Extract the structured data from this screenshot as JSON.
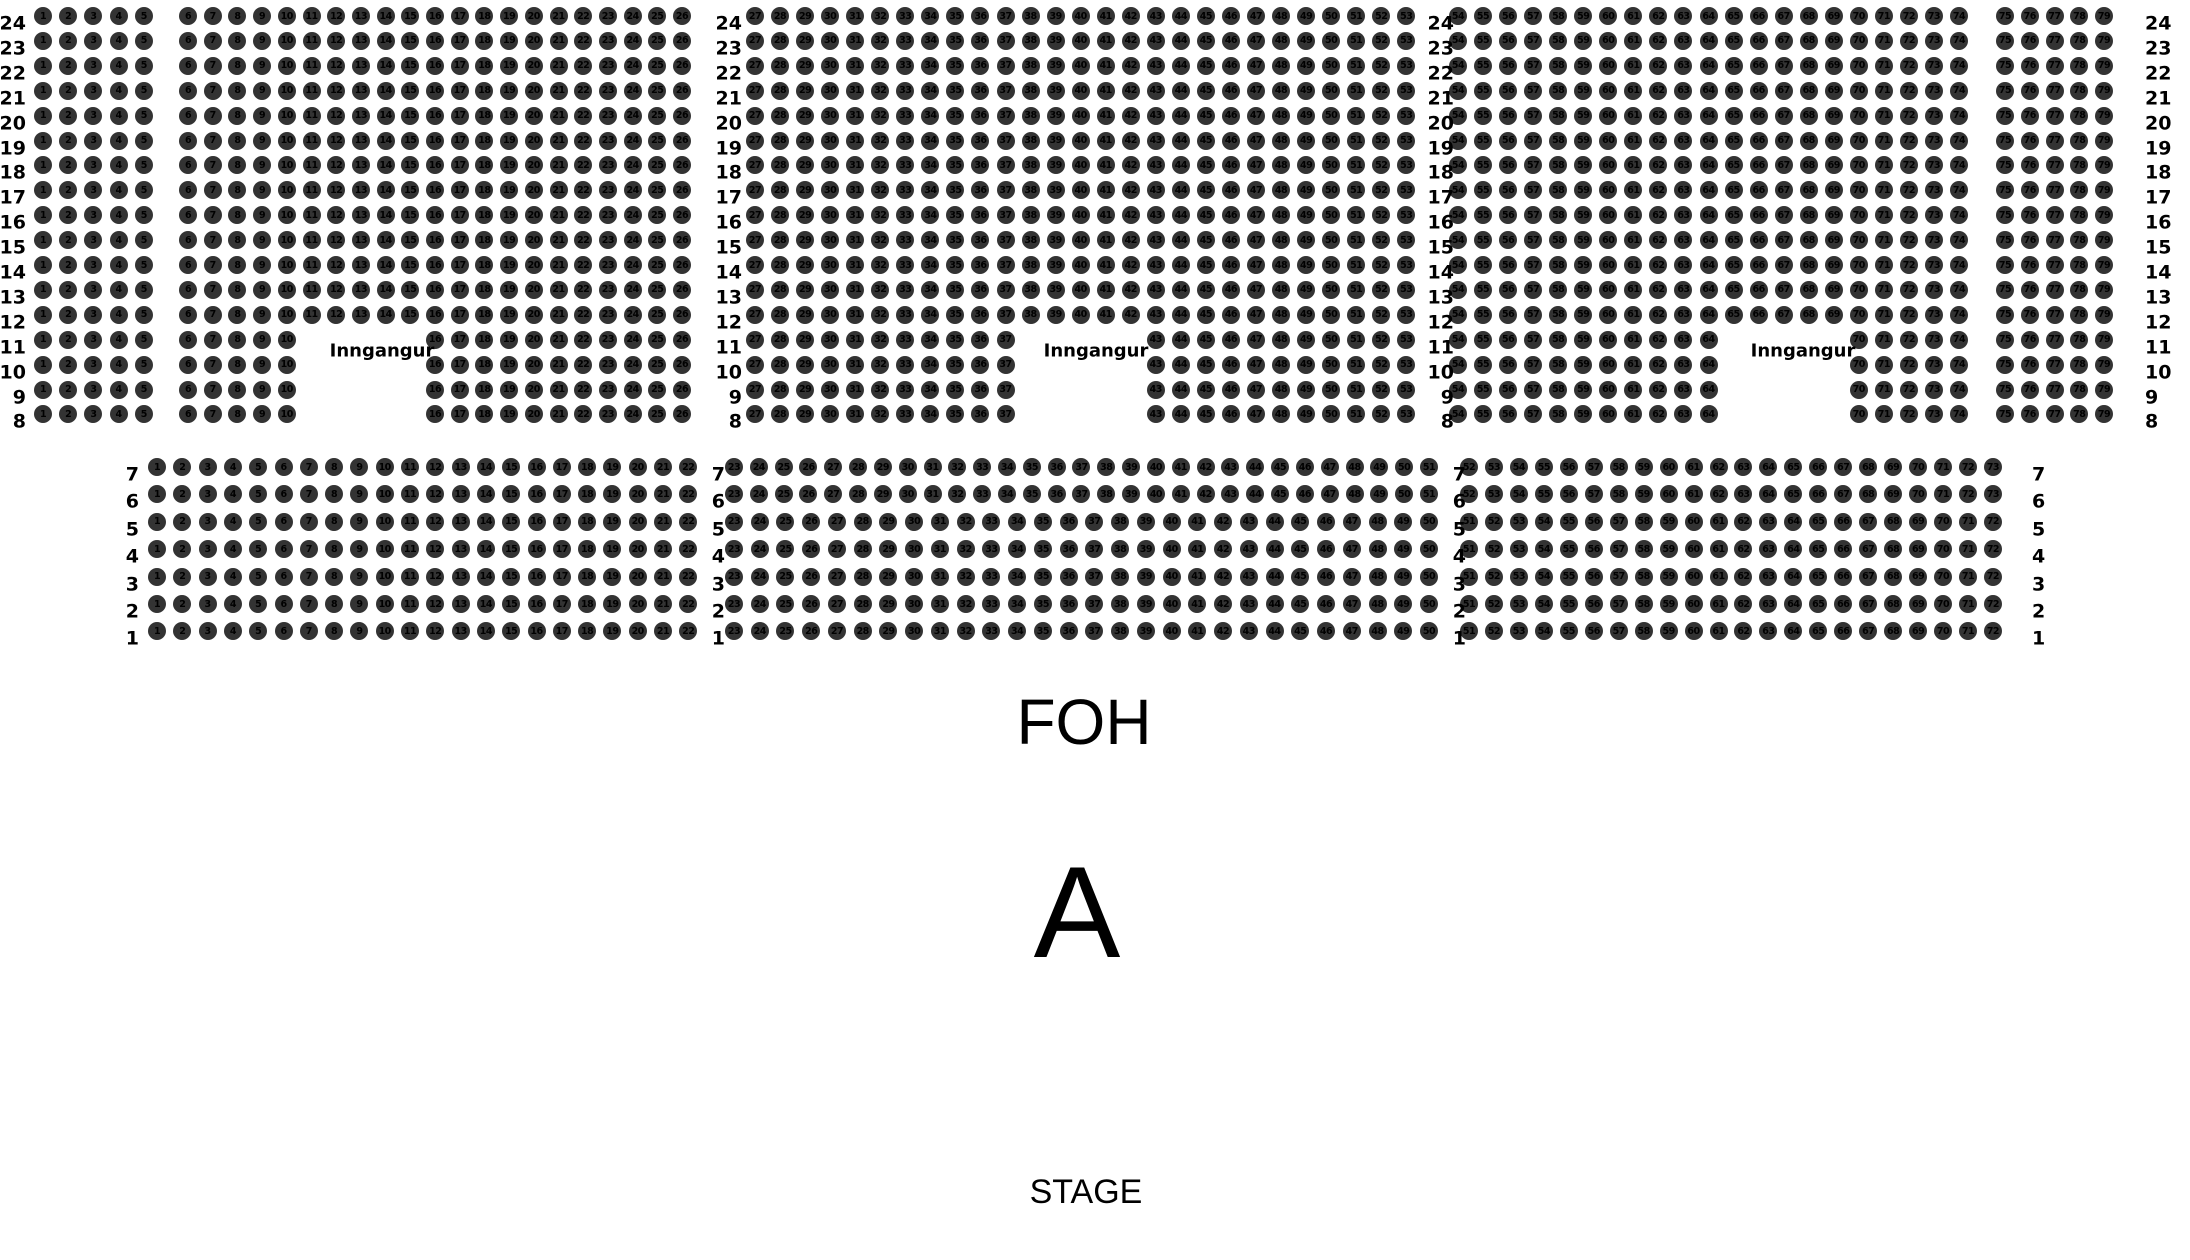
{
  "page": {
    "width": 2190,
    "height": 1260,
    "background": "#ffffff"
  },
  "colors": {
    "seat_fill": "#333333",
    "seat_number_text": "#000000",
    "label_text": "#000000"
  },
  "labels": {
    "entrance": "Inngangur",
    "foh": "FOH",
    "section_letter": "A",
    "stage": "STAGE"
  },
  "seat_geometry": {
    "diameter": 18,
    "number_font_size": 9.5,
    "row_label_font_size": 19,
    "entrance_font_size": 18,
    "row_label_dy": 8
  },
  "upper_section": {
    "row_numbers": [
      24,
      23,
      22,
      21,
      20,
      19,
      18,
      17,
      16,
      15,
      14,
      13,
      12,
      11,
      10,
      9,
      8
    ],
    "rows_with_entrance_gap": [
      11,
      10,
      9,
      8
    ],
    "top_row_y": 16,
    "row_pitch": 24.9,
    "label_columns": [
      {
        "x": 26,
        "align": "right"
      },
      {
        "x": 742,
        "align": "right"
      },
      {
        "x": 1454,
        "align": "right"
      },
      {
        "x": 2145,
        "align": "left"
      }
    ],
    "blocks": [
      {
        "first_seat": 1,
        "last_seat": 5,
        "x_first": 43,
        "seat_pitch": 25.2
      },
      {
        "first_seat": 6,
        "last_seat": 26,
        "x_first": 188,
        "seat_pitch": 24.7,
        "entrance_gap": {
          "first": 11,
          "last": 15
        }
      },
      {
        "first_seat": 27,
        "last_seat": 53,
        "x_first": 755,
        "seat_pitch": 25.05,
        "entrance_gap": {
          "first": 38,
          "last": 42
        }
      },
      {
        "first_seat": 54,
        "last_seat": 74,
        "x_first": 1458,
        "seat_pitch": 25.05,
        "entrance_gap": {
          "first": 65,
          "last": 69
        }
      },
      {
        "first_seat": 75,
        "last_seat": 79,
        "x_first": 2005,
        "seat_pitch": 24.75
      }
    ],
    "entrance_labels": [
      {
        "x": 382,
        "y": 351
      },
      {
        "x": 1096,
        "y": 351
      },
      {
        "x": 1803,
        "y": 351
      }
    ]
  },
  "lower_section": {
    "row_numbers": [
      7,
      6,
      5,
      4,
      3,
      2,
      1
    ],
    "top_row_y": 467,
    "row_pitch": 27.4,
    "label_columns": [
      {
        "x": 139,
        "align": "right"
      },
      {
        "x": 725,
        "align": "right"
      },
      {
        "x": 1466,
        "align": "right"
      },
      {
        "x": 2032,
        "align": "left"
      }
    ],
    "row_variants": [
      {
        "row_numbers": [
          7,
          6
        ],
        "blocks": [
          {
            "first_seat": 1,
            "last_seat": 22,
            "x_first": 157,
            "seat_pitch": 25.3
          },
          {
            "first_seat": 23,
            "last_seat": 51,
            "x_first": 734,
            "seat_pitch": 24.82
          },
          {
            "first_seat": 52,
            "last_seat": 73,
            "x_first": 1469,
            "seat_pitch": 24.95
          }
        ]
      },
      {
        "row_numbers": [
          5,
          4,
          3,
          2,
          1
        ],
        "blocks": [
          {
            "first_seat": 1,
            "last_seat": 22,
            "x_first": 157,
            "seat_pitch": 25.3
          },
          {
            "first_seat": 23,
            "last_seat": 50,
            "x_first": 734,
            "seat_pitch": 25.74
          },
          {
            "first_seat": 51,
            "last_seat": 72,
            "x_first": 1469,
            "seat_pitch": 24.95
          }
        ]
      }
    ]
  },
  "annotations": {
    "foh": {
      "x": 1084,
      "y": 722,
      "font_size": 64
    },
    "section_letter": {
      "x": 1077,
      "y": 912,
      "font_size": 130
    },
    "stage": {
      "x": 1086,
      "y": 1192,
      "font_size": 34
    }
  }
}
